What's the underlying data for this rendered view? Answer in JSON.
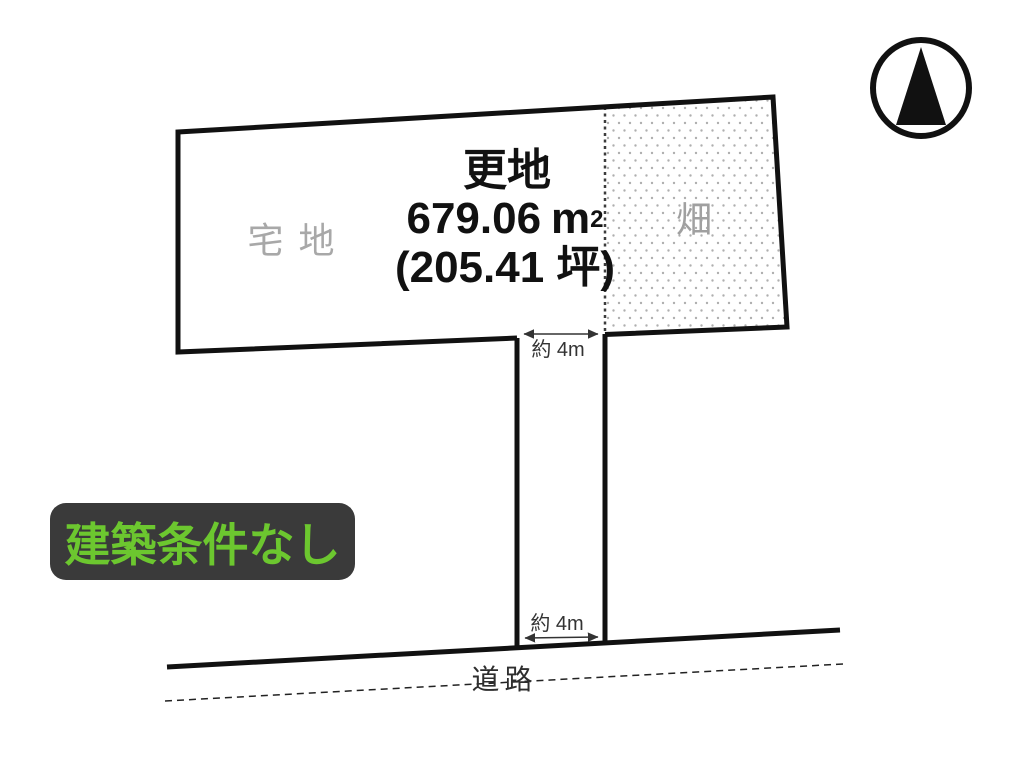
{
  "diagram": {
    "title_hint": "land-plot-layout",
    "labels": {
      "vacant": "更地",
      "area_value": "679.06",
      "area_unit": "m",
      "area_exp": "2",
      "area_tsubo": "(205.41 坪)",
      "zoning_residential": "宅地",
      "zoning_field": "畑",
      "dim_top": "約 4m",
      "dim_bottom": "約 4m",
      "road": "道路",
      "badge": "建築条件なし"
    },
    "colors": {
      "badge_bg": "#3A3A3A",
      "badge_text": "#6CC72F",
      "zoning_label_gray": "#A8A8A8",
      "outline_black": "#111111",
      "dimension_gray": "#333333",
      "field_dot_gray": "#AFAFAF"
    },
    "icons": {
      "north": "north-arrow"
    }
  }
}
